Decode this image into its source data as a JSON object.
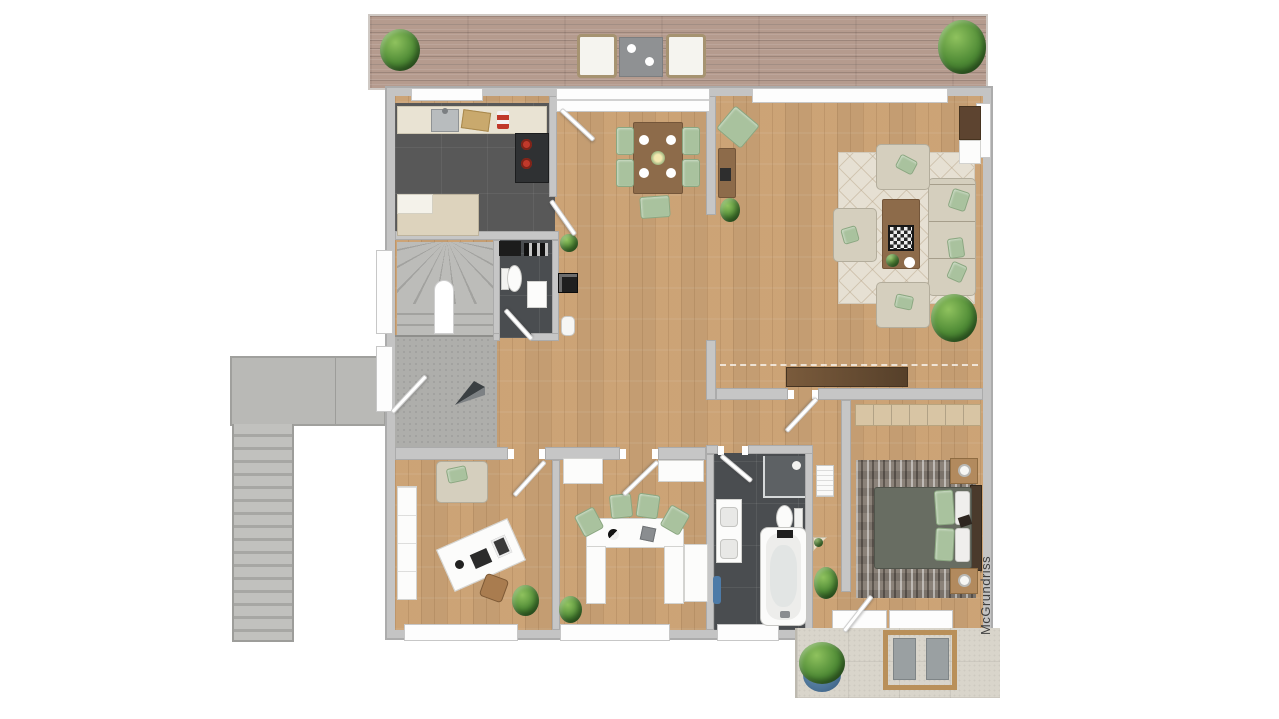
{
  "watermark": {
    "text": "McGrundriss"
  },
  "palette": {
    "background": "#ffffff",
    "wall_gray": "#c6c6c6",
    "wood_floor": "#cfa87c",
    "terrace_wood": "#b59b8e",
    "dark_tile": "#4a4d50",
    "kitchen_tile": "#585858",
    "concrete_gray": "#aeaeab",
    "patio_stone": "#d9d5cb",
    "sage_green": "#a9c29e",
    "sofa_beige": "#d5cfbe",
    "furniture_wood": "#8d6b4a",
    "plant_green": "#4e8a35",
    "stove_red": "#c0392b",
    "towel_blue": "#4d7ba8",
    "pot_blue": "#4c7396"
  },
  "areas": {
    "upper_terrace": {
      "items": [
        "potted-plant-left",
        "armchair-left",
        "side-table",
        "armchair-right",
        "potted-plant-right"
      ]
    },
    "kitchen": {
      "items": [
        "countertop",
        "sink",
        "cutting-board",
        "spice-jars",
        "stove",
        "base-cabinet"
      ]
    },
    "dining_area": {
      "items": [
        "dining-table",
        "dining-chairs-5",
        "plates-4",
        "centerpiece",
        "pouf",
        "wall-sideboard",
        "floor-plant"
      ]
    },
    "living_room": {
      "items": [
        "area-rug",
        "sofa",
        "armchair-top",
        "armchair-left",
        "armchair-bottom",
        "coffee-table",
        "chessboard",
        "floor-plant",
        "media-console",
        "low-sideboard"
      ]
    },
    "stair_hall": {
      "items": [
        "winder-staircase",
        "arch-marker",
        "entrance-arrow",
        "entry-door"
      ]
    },
    "wc": {
      "items": [
        "counter",
        "vent-grilles",
        "toilet",
        "washbasin"
      ]
    },
    "hall_decor": {
      "items": [
        "plant",
        "mirror",
        "bin"
      ]
    },
    "office": {
      "items": [
        "loveseat",
        "wardrobe",
        "desk",
        "laptop",
        "chair",
        "plant"
      ]
    },
    "kids_room": {
      "items": [
        "cabinet-left",
        "cabinet-right",
        "u-shaped-desk",
        "desk-chairs-4",
        "globe",
        "storage-box",
        "tall-cabinet",
        "plant"
      ]
    },
    "bathroom": {
      "items": [
        "shower",
        "toilet",
        "double-vanity",
        "bathtub",
        "tray",
        "towel"
      ]
    },
    "bedroom": {
      "items": [
        "wardrobe",
        "area-rug",
        "double-bed",
        "pillows",
        "nightstand-top",
        "nightstand-bottom",
        "radiator",
        "corner-shelf",
        "plant"
      ]
    },
    "exterior": {
      "items": [
        "entry-landing",
        "exterior-staircase",
        "patio",
        "lounge-set",
        "potted-plant-blue-pot"
      ]
    }
  }
}
